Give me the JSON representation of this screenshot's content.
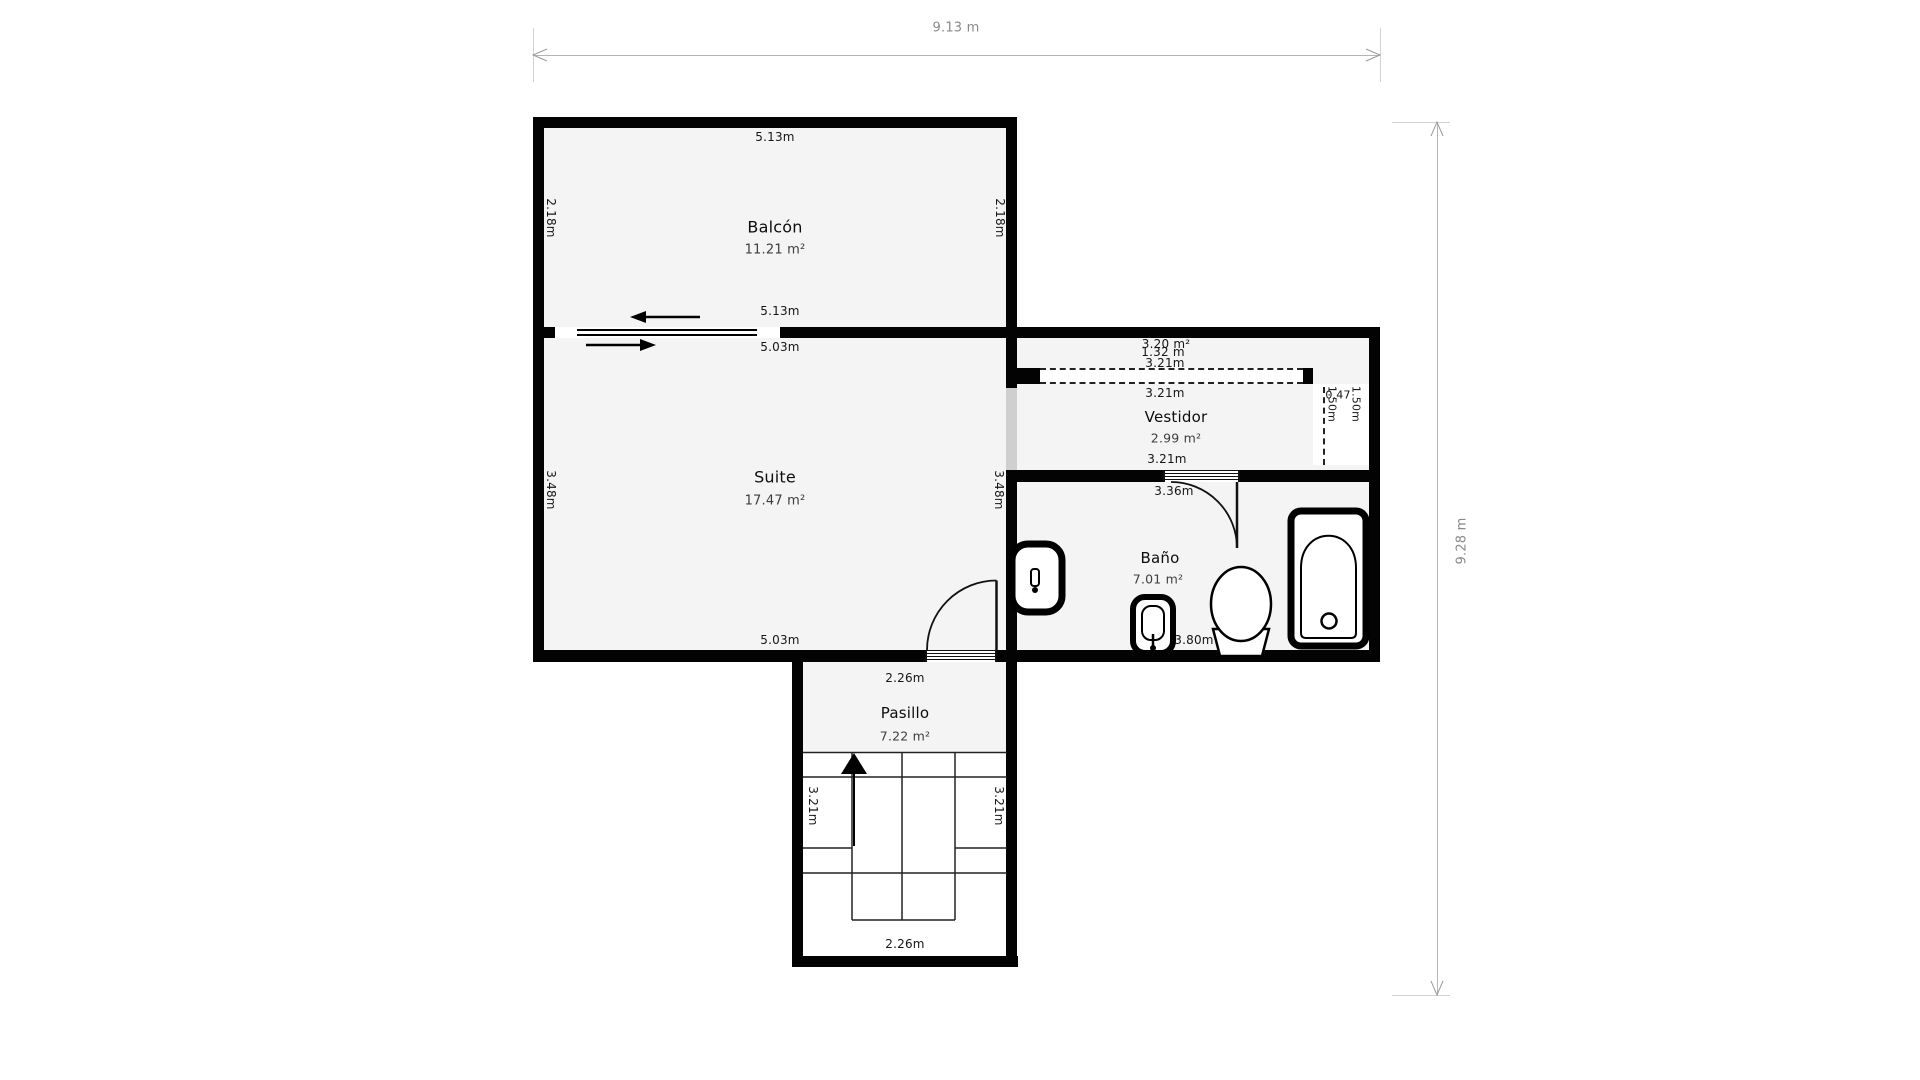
{
  "plan": {
    "overall_width_label": "9.13 m",
    "overall_height_label": "9.28 m"
  },
  "rooms": {
    "balcon": {
      "name": "Balcón",
      "area": "11.21 m²",
      "dim_top": "5.13m",
      "dim_left": "2.18m",
      "dim_right": "2.18m",
      "dim_bottom_outer": "5.13m",
      "dim_bottom_inner": "5.03m"
    },
    "suite": {
      "name": "Suite",
      "area": "17.47 m²",
      "dim_left": "3.48m",
      "dim_right": "3.48m",
      "dim_bottom": "5.03m"
    },
    "strip": {
      "area": "3.20 m²",
      "dim_height": "1.32 m",
      "dim_width": "3.21m"
    },
    "vestidor": {
      "name": "Vestidor",
      "area": "2.99 m²",
      "dim_top": "3.21m",
      "dim_bottom": "3.21m"
    },
    "closet_right": {
      "dim_width": "0.47",
      "dim_height_a": "1.50m",
      "dim_height_b": "1.50m"
    },
    "bano": {
      "name": "Baño",
      "area": "7.01 m²",
      "dim_top": "3.36m",
      "dim_bottom": "3.80m",
      "dim_left": "1.43m",
      "dim_right": "1.84m"
    },
    "pasillo": {
      "name": "Pasillo",
      "area": "7.22 m²",
      "dim_top": "2.26m",
      "dim_bottom": "2.26m",
      "dim_left": "3.21m",
      "dim_right": "3.21m"
    }
  },
  "colors": {
    "wall": "#030303",
    "room_fill": "#f4f4f4",
    "dim_gray": "#8a8a8a"
  }
}
